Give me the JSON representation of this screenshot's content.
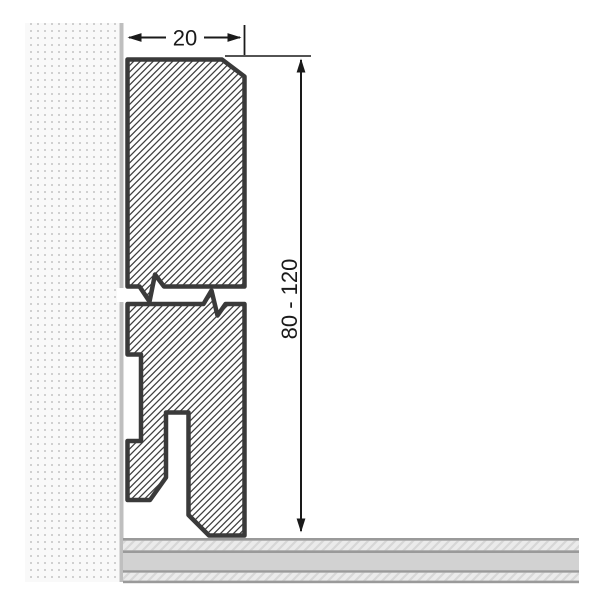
{
  "diagram": {
    "width_dimension": {
      "label": "20"
    },
    "height_dimension": {
      "label": "80 - 120"
    },
    "colors": {
      "outline": "#3a3a3a",
      "dimension": "#1a1a1a",
      "hatch_line": "#3f3f3f",
      "wall_background": "#f9f9f9",
      "wall_dot": "#d0d0d0",
      "wall_edge": "#bfbfbf",
      "floor_border": "#9a9a9a",
      "floor_core": "#d2d2d2",
      "floor_hatch_background": "#ebebeb",
      "floor_hatch_line": "#d7d7d7"
    }
  }
}
